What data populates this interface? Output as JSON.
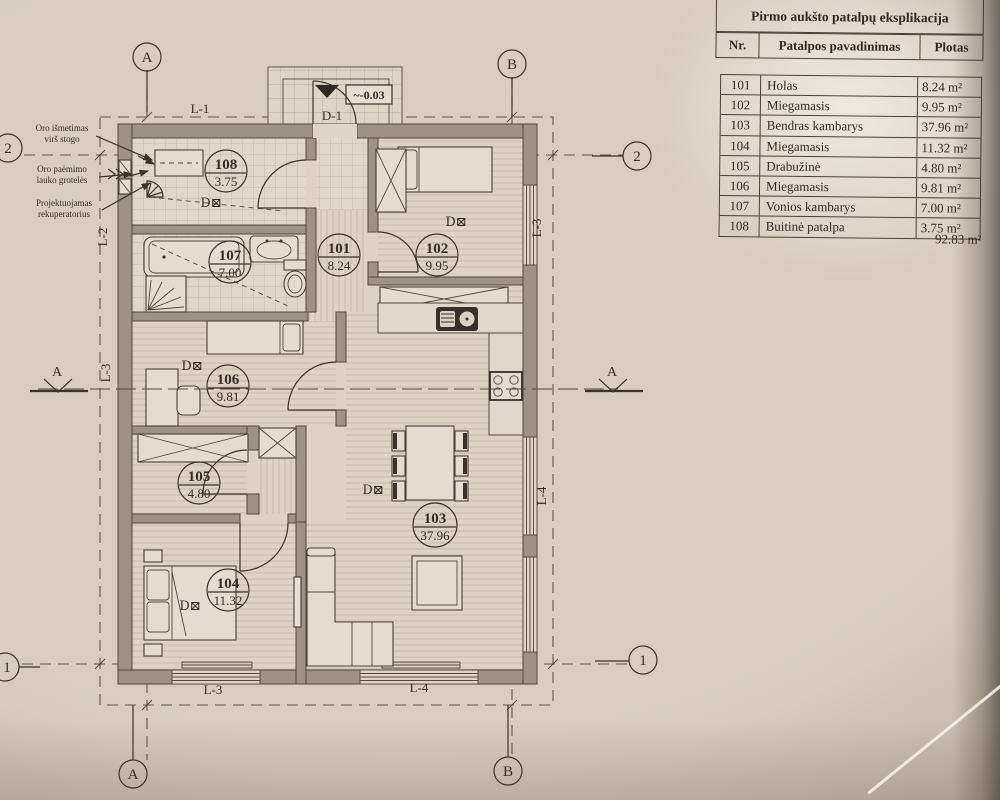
{
  "table": {
    "title": "Pirmo aukšto patalpų eksplikacija",
    "headers": {
      "nr": "Nr.",
      "name": "Patalpos pavadinimas",
      "area": "Plotas"
    },
    "rows": [
      {
        "nr": "101",
        "name": "Holas",
        "area": "8.24 m²"
      },
      {
        "nr": "102",
        "name": "Miegamasis",
        "area": "9.95 m²"
      },
      {
        "nr": "103",
        "name": "Bendras kambarys",
        "area": "37.96 m²"
      },
      {
        "nr": "104",
        "name": "Miegamasis",
        "area": "11.32 m²"
      },
      {
        "nr": "105",
        "name": "Drabužinė",
        "area": "4.80 m²"
      },
      {
        "nr": "106",
        "name": "Miegamasis",
        "area": "9.81 m²"
      },
      {
        "nr": "107",
        "name": "Vonios kambarys",
        "area": "7.00 m²"
      },
      {
        "nr": "108",
        "name": "Buitinė patalpa",
        "area": "3.75 m²"
      }
    ],
    "total": "92.83 m²"
  },
  "plan": {
    "rooms": [
      {
        "nr": "101",
        "area": "8.24"
      },
      {
        "nr": "102",
        "area": "9.95"
      },
      {
        "nr": "103",
        "area": "37.96"
      },
      {
        "nr": "104",
        "area": "11.32"
      },
      {
        "nr": "105",
        "area": "4.80"
      },
      {
        "nr": "106",
        "area": "9.81"
      },
      {
        "nr": "107",
        "area": "7.00"
      },
      {
        "nr": "108",
        "area": "3.75"
      }
    ],
    "detector": "D⊠",
    "door_label": "D-1",
    "level_mark": "~-0.03",
    "grid": {
      "l1": "L-1",
      "l2": "L-2",
      "l3": "L-3",
      "l4": "L-4"
    },
    "axes": {
      "a": "A",
      "b": "B",
      "n1": "1",
      "n2": "2"
    },
    "section": "A",
    "notes": [
      {
        "l1": "Oro išmetimas",
        "l2": "virš stogo"
      },
      {
        "l1": "Oro paėmimo",
        "l2": "lauko grotelės"
      },
      {
        "l1": "Projektuojamas",
        "l2": "rekuperatorius"
      }
    ]
  },
  "colors": {
    "ink": "#3a342a",
    "wall": "#9c9383",
    "paper": "#d7cebd"
  }
}
